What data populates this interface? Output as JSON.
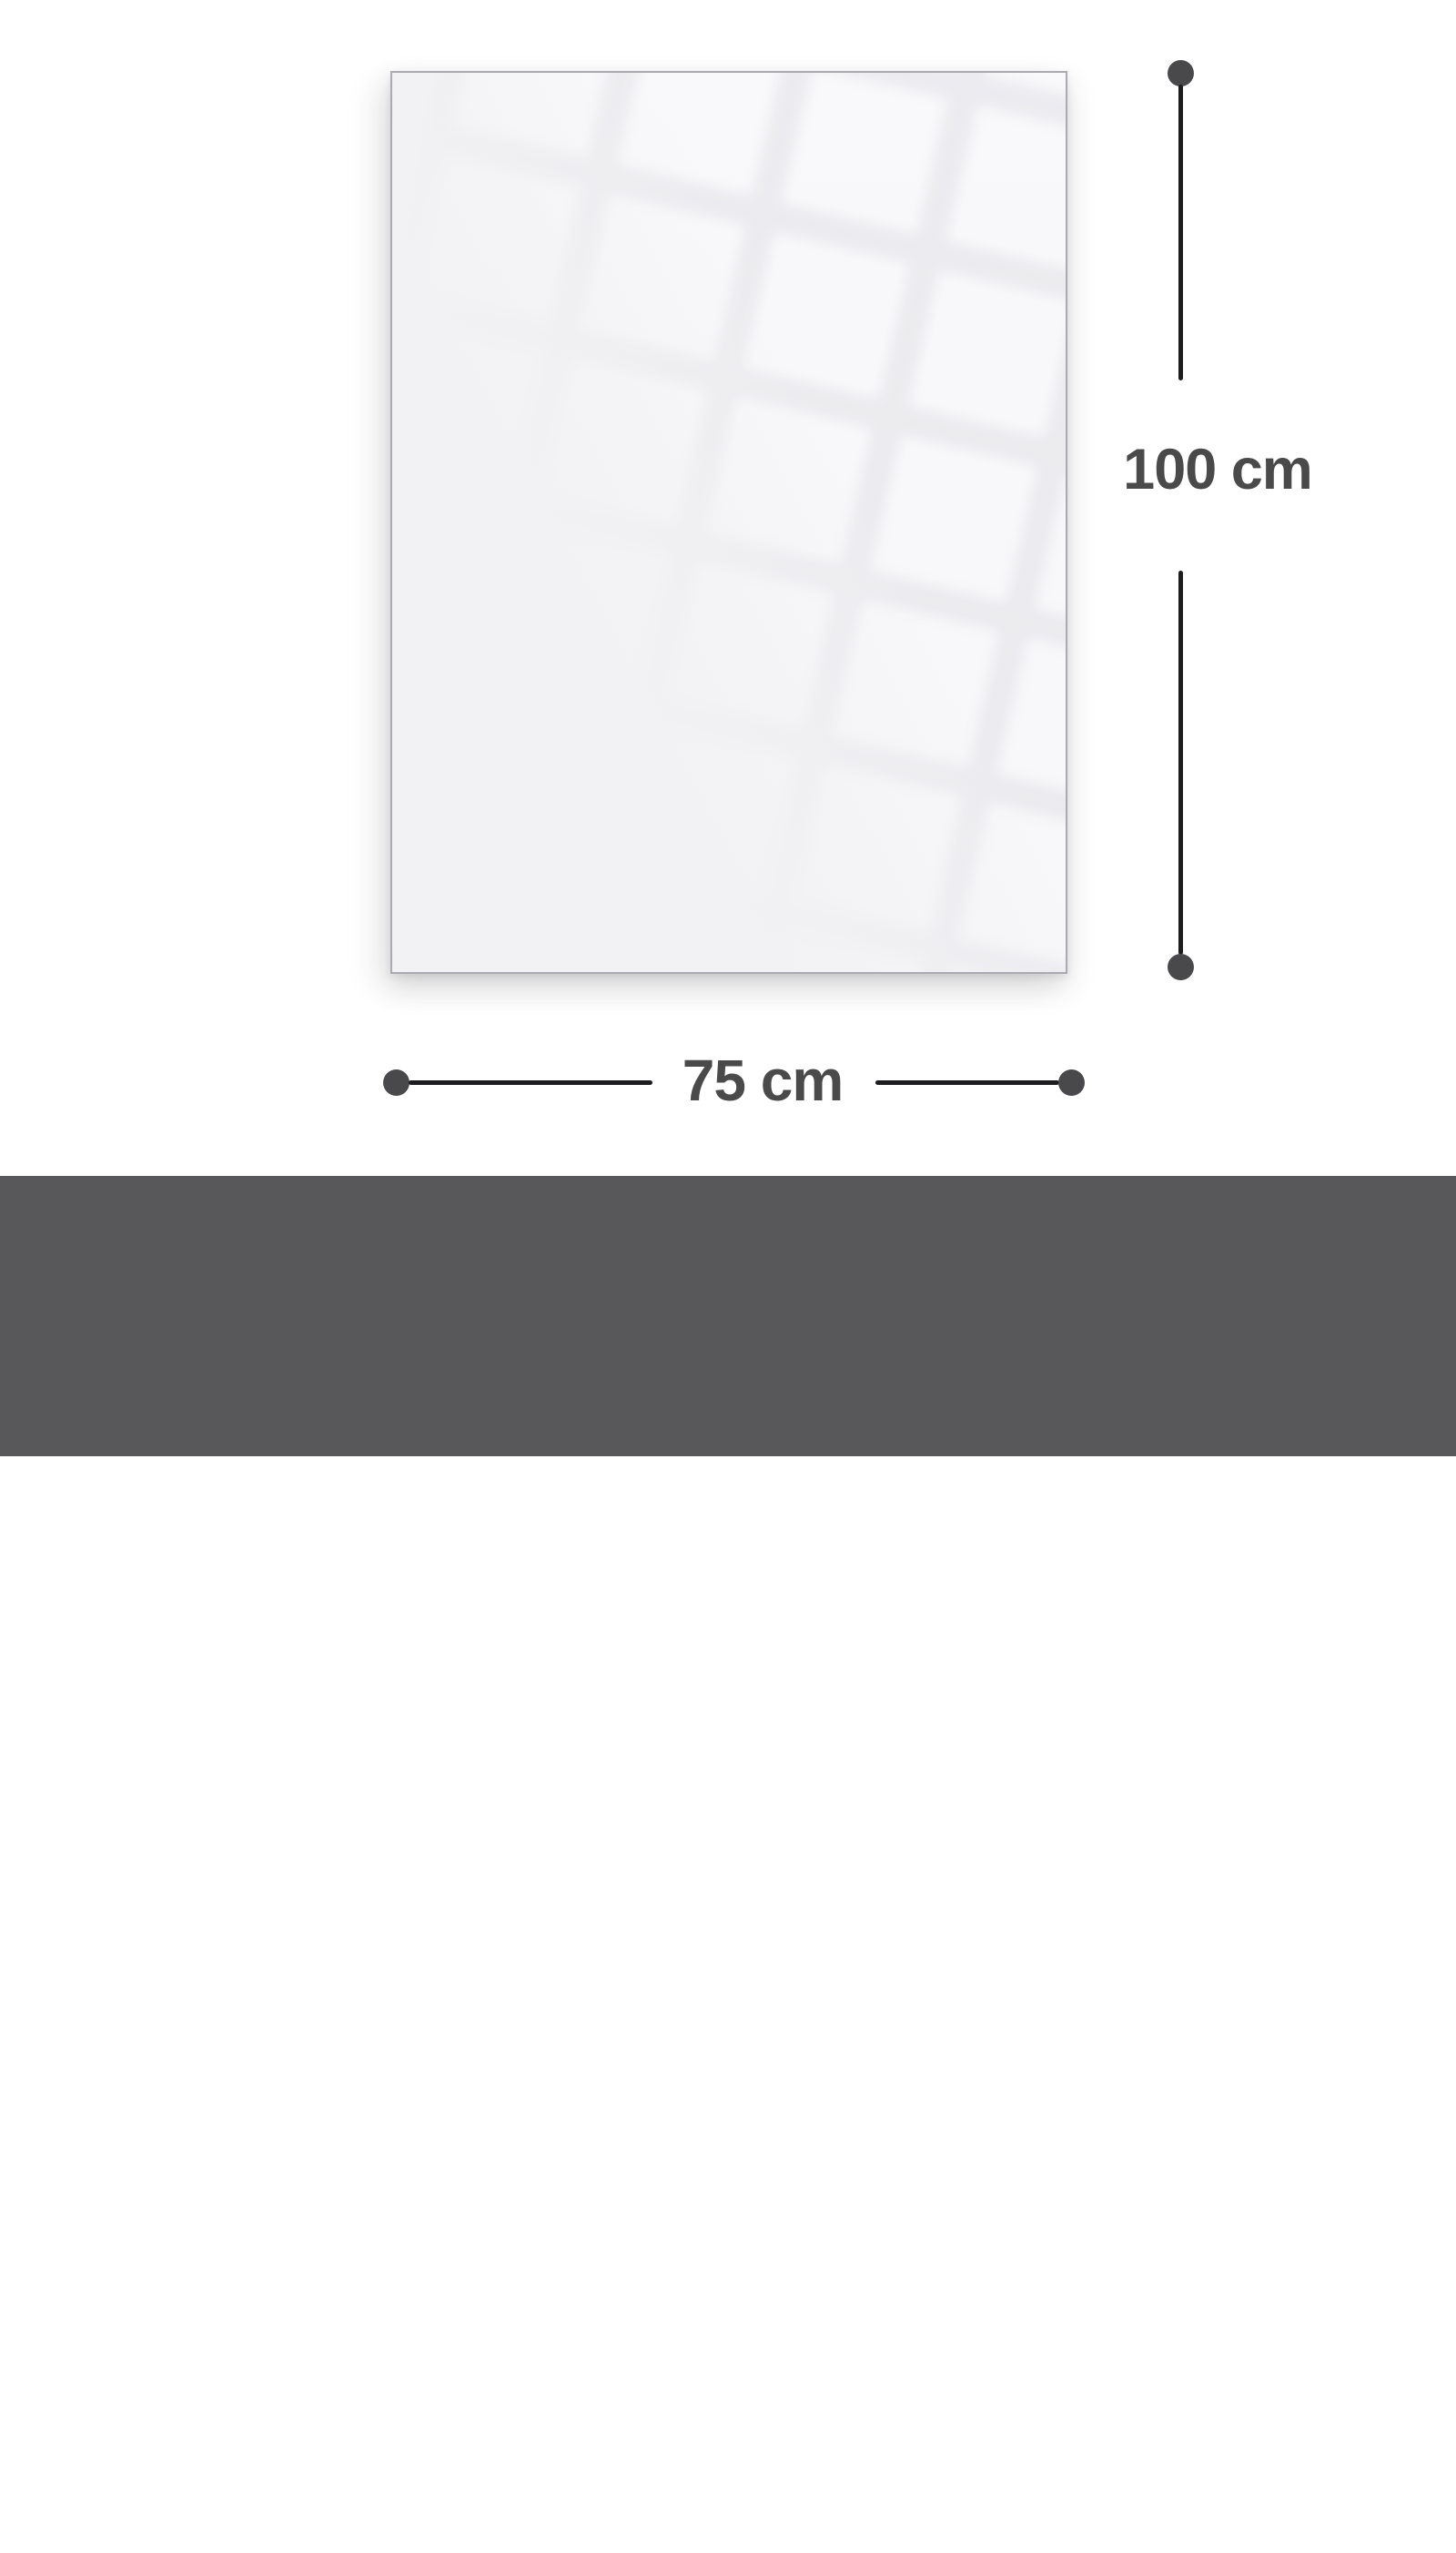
{
  "diagram": {
    "height_dimension": {
      "label": "100 cm"
    },
    "width_dimension": {
      "label": "75 cm"
    }
  },
  "footer": {
    "caption": "Gesamtgrösse | Size",
    "size": "75 x 100 cm"
  },
  "colors": {
    "page_bg": "#ffffff",
    "panel_fill": "#f2f2f4",
    "panel_border": "#aaabb0",
    "dimension_line": "#1d1d1f",
    "dimension_dot": "#49494c",
    "dimension_text": "#4a4a4b",
    "footer_bg": "#58585a",
    "footer_text": "#ffffff"
  }
}
